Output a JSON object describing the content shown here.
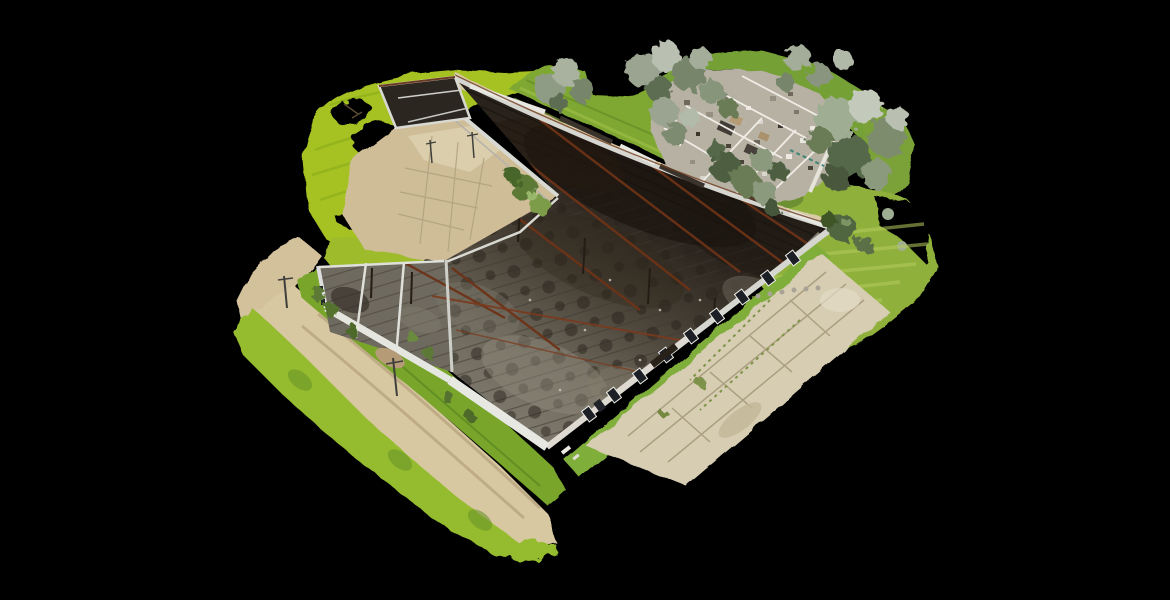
{
  "scene": {
    "description": "Oblique aerial 3D photogrammetry model of a burned-out roofless industrial warehouse complex, shown floating on a solid black background",
    "view": "orbit viewpoint from south-west, high angle",
    "background_color": "#000000",
    "model_parts": [
      "burned warehouse hall with exposed rusted roof trusses",
      "west annex rooms",
      "south-west wing rooms",
      "ruined rubble outbuilding at north-east",
      "mowed bright lawn north-west with scan holes",
      "grass field east with mowing stripes",
      "dirt road with wheel tracks along south-west side",
      "cracked concrete apron south-east",
      "tree canopies along north edge",
      "utility poles along the road"
    ]
  },
  "palette": {
    "background": "#000000",
    "grassBright": "#a6c220",
    "grassTongue": "#9dbb2a",
    "grassMid": "#7fa830",
    "grassField": "#8fb13b",
    "grassStrip": "#78a52c",
    "grassFringe": "#95bb2f",
    "grassSE": "#7fae3a",
    "grassDark": "#5e8130",
    "dirtRoad": "#d8c8a2",
    "dirtBulge": "#d2c19b",
    "dirtCourtyard": "#cfbd98",
    "slabLight": "#dccfae",
    "pathStrip": "#d8cba6",
    "concreteApron": "#d6cdb2",
    "rubbleBase": "#b6b1a3",
    "wallLight": "#e8e8e2",
    "wallMid": "#d6d6d0",
    "wallShade": "#b5b2aa",
    "charDark": "#2c2620",
    "floorGrey": "#6f6a5f",
    "rustBeam": "#6d3318",
    "windowDark": "#1c2026",
    "foliageGrey": "#9aa490",
    "foliageDark": "#4e5f41",
    "poleGrey": "#3f3f3b"
  }
}
